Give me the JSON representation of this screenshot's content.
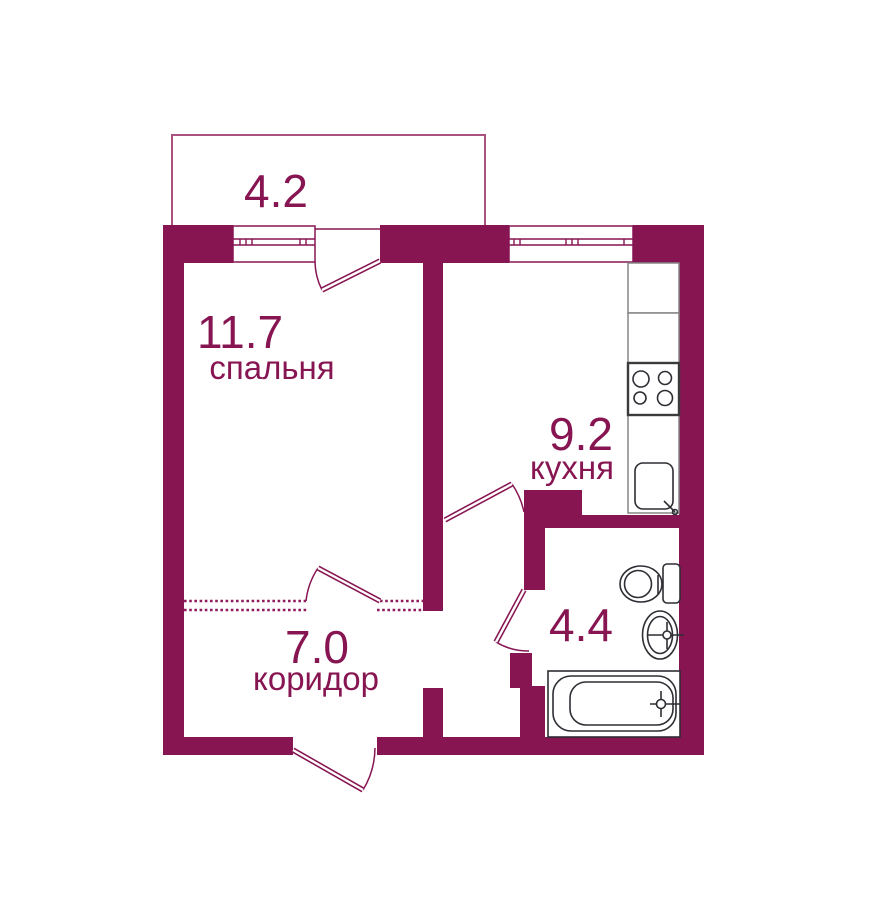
{
  "rooms": {
    "balcony": {
      "area": "4.2"
    },
    "bedroom": {
      "area": "11.7",
      "name": "спальня"
    },
    "kitchen": {
      "area": "9.2",
      "name": "кухня"
    },
    "corridor": {
      "area": "7.0",
      "name": "коридор"
    },
    "bathroom": {
      "area": "4.4"
    }
  },
  "colors": {
    "wall": "#871552",
    "balcony_outline": "#a9517f",
    "dashed_boundary": "#8f1d5e",
    "fixture_line": "#2e2e34",
    "counter_line": "#858585",
    "background": "#ffffff"
  }
}
